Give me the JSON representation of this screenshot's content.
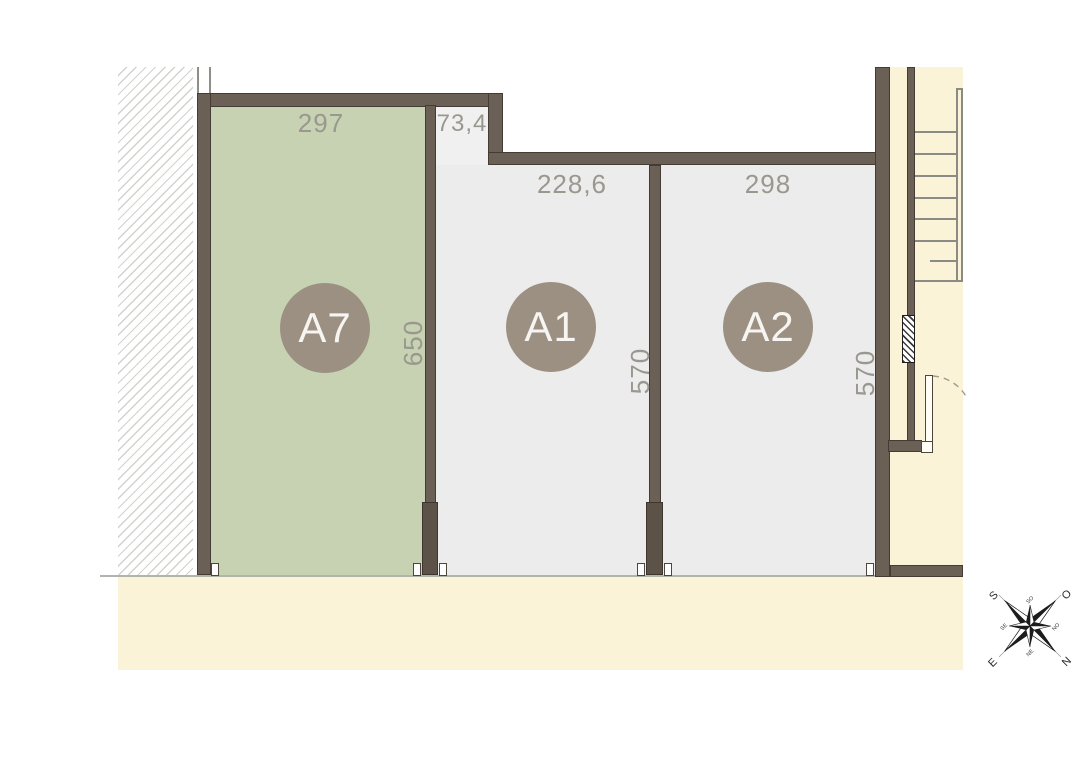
{
  "units": [
    {
      "id": "A7",
      "top_dim": "297",
      "side_dim": "650"
    },
    {
      "id": "A1",
      "top_dim": "228,6",
      "notch_dim": "73,4",
      "side_dim": "570"
    },
    {
      "id": "A2",
      "top_dim": "298",
      "side_dim": "570"
    }
  ],
  "compass": {
    "s": "S",
    "o": "O",
    "n": "N",
    "e": "E",
    "so": "SO",
    "no": "NO",
    "ne": "NE",
    "se": "SE"
  },
  "colors": {
    "unit_a7_fill": "#c6d2b2",
    "unit_fill": "#ececec",
    "wall_fill": "#6a6055",
    "wall_outline": "#443c34",
    "cream": "#faf3d8",
    "badge": "#9c9083",
    "dimension_text": "#9a978f"
  }
}
